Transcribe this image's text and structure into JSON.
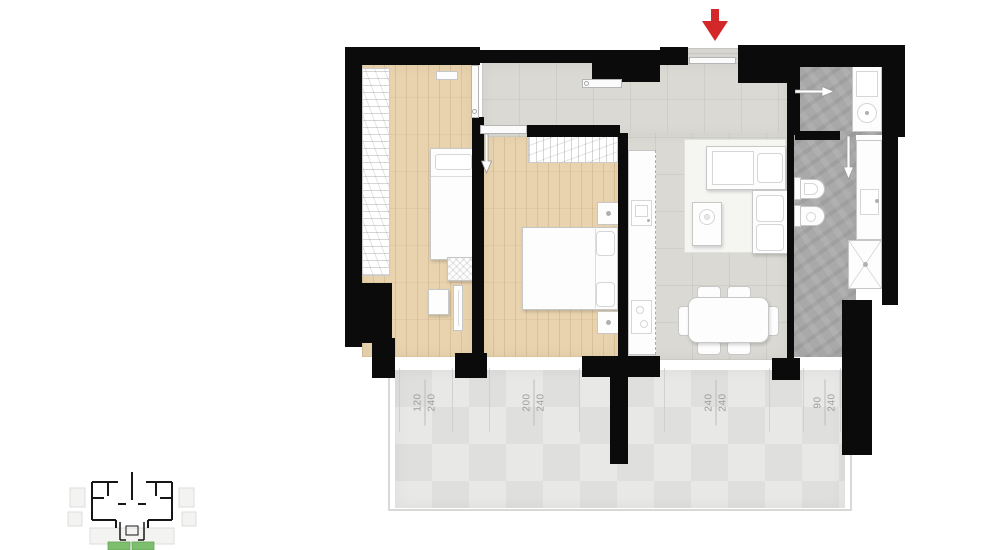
{
  "plan": {
    "entrance": {
      "arrow_icon": "entrance-arrow-icon",
      "arrow_color": "#d3282a"
    },
    "window_dimensions": [
      {
        "width": "120",
        "height": "240"
      },
      {
        "width": "200",
        "height": "240"
      },
      {
        "width": "240",
        "height": "240"
      },
      {
        "width": "90",
        "height": "240"
      }
    ],
    "colors": {
      "wall": "#0b0b0b",
      "wood_floor": "#e8d3ae",
      "tile_floor": "#dad9d3",
      "stone_floor": "#a9a9a9",
      "balcony_floor": "#e3e3e1",
      "dimension_text": "#9d9d9d",
      "key_plan_highlight": "#7cbf6d"
    }
  }
}
